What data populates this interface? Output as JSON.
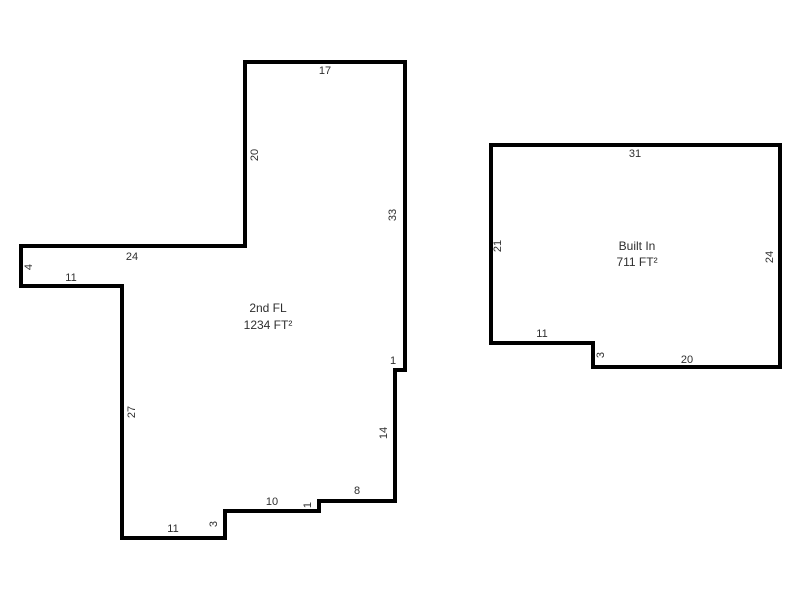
{
  "canvas": {
    "width": 800,
    "height": 600,
    "background": "#ffffff"
  },
  "style": {
    "outline_color": "#000000",
    "outline_width": 4,
    "label_color": "#2e2e2e"
  },
  "floors": [
    {
      "name": "2nd FL",
      "area": "1234 FT²",
      "name_pos": {
        "x": 268,
        "y": 308
      },
      "area_pos": {
        "x": 268,
        "y": 325
      },
      "outline": [
        [
          245,
          62
        ],
        [
          405,
          62
        ],
        [
          405,
          370
        ],
        [
          395,
          370
        ],
        [
          395,
          501
        ],
        [
          319,
          501
        ],
        [
          319,
          511
        ],
        [
          225,
          511
        ],
        [
          225,
          538
        ],
        [
          122,
          538
        ],
        [
          122,
          286
        ],
        [
          21,
          286
        ],
        [
          21,
          246
        ],
        [
          245,
          246
        ]
      ],
      "edge_labels": [
        {
          "text": "17",
          "x": 325,
          "y": 71,
          "rotate": false
        },
        {
          "text": "33",
          "x": 393,
          "y": 215,
          "rotate": true
        },
        {
          "text": "1",
          "x": 393,
          "y": 361,
          "rotate": false
        },
        {
          "text": "14",
          "x": 384,
          "y": 433,
          "rotate": true
        },
        {
          "text": "8",
          "x": 357,
          "y": 491,
          "rotate": false
        },
        {
          "text": "1",
          "x": 308,
          "y": 505,
          "rotate": true
        },
        {
          "text": "10",
          "x": 272,
          "y": 502,
          "rotate": false
        },
        {
          "text": "3",
          "x": 214,
          "y": 524,
          "rotate": true
        },
        {
          "text": "11",
          "x": 173,
          "y": 529,
          "rotate": false
        },
        {
          "text": "27",
          "x": 132,
          "y": 412,
          "rotate": true
        },
        {
          "text": "11",
          "x": 71,
          "y": 278,
          "rotate": false
        },
        {
          "text": "4",
          "x": 29,
          "y": 267,
          "rotate": true
        },
        {
          "text": "24",
          "x": 132,
          "y": 257,
          "rotate": false
        },
        {
          "text": "20",
          "x": 255,
          "y": 155,
          "rotate": true
        }
      ]
    },
    {
      "name": "Built In",
      "area": "711 FT²",
      "name_pos": {
        "x": 637,
        "y": 246
      },
      "area_pos": {
        "x": 637,
        "y": 262
      },
      "outline": [
        [
          491,
          145
        ],
        [
          780,
          145
        ],
        [
          780,
          367
        ],
        [
          593,
          367
        ],
        [
          593,
          343
        ],
        [
          491,
          343
        ]
      ],
      "edge_labels": [
        {
          "text": "31",
          "x": 635,
          "y": 154,
          "rotate": false
        },
        {
          "text": "24",
          "x": 770,
          "y": 257,
          "rotate": true
        },
        {
          "text": "20",
          "x": 687,
          "y": 360,
          "rotate": false
        },
        {
          "text": "3",
          "x": 601,
          "y": 355,
          "rotate": true
        },
        {
          "text": "11",
          "x": 542,
          "y": 334,
          "rotate": false
        },
        {
          "text": "21",
          "x": 498,
          "y": 246,
          "rotate": true
        }
      ]
    }
  ]
}
